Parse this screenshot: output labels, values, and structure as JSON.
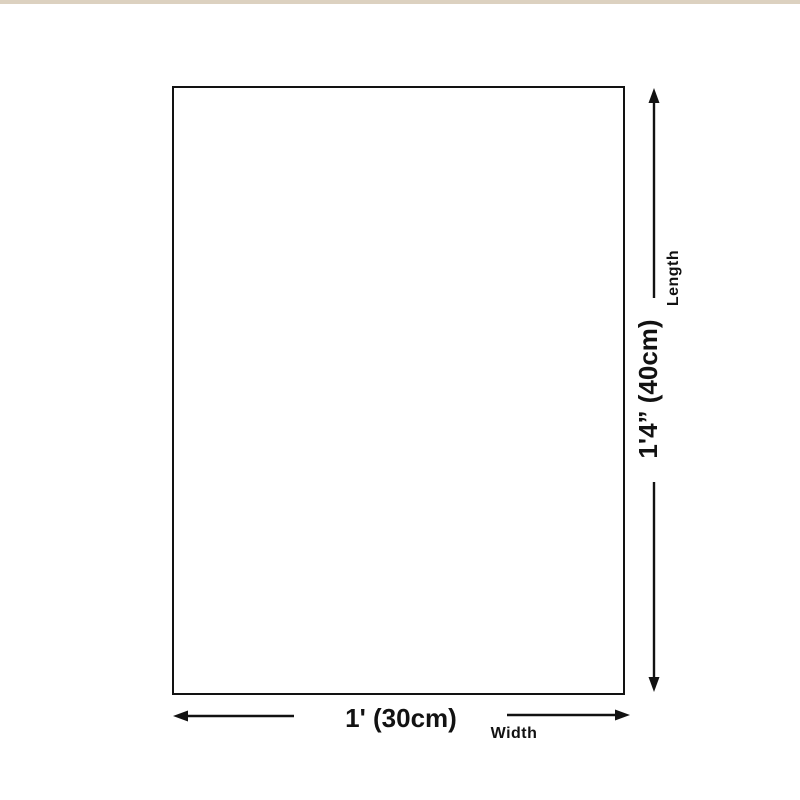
{
  "colors": {
    "page-bg": "#ffffff",
    "top-accent": "#dcd1c0",
    "ink": "#121212",
    "canvas-bg": "#ffffff"
  },
  "diagram": {
    "length": {
      "value": "1'4” (40cm)",
      "label": "Length"
    },
    "width": {
      "value": "1' (30cm)",
      "label": "Width"
    }
  }
}
